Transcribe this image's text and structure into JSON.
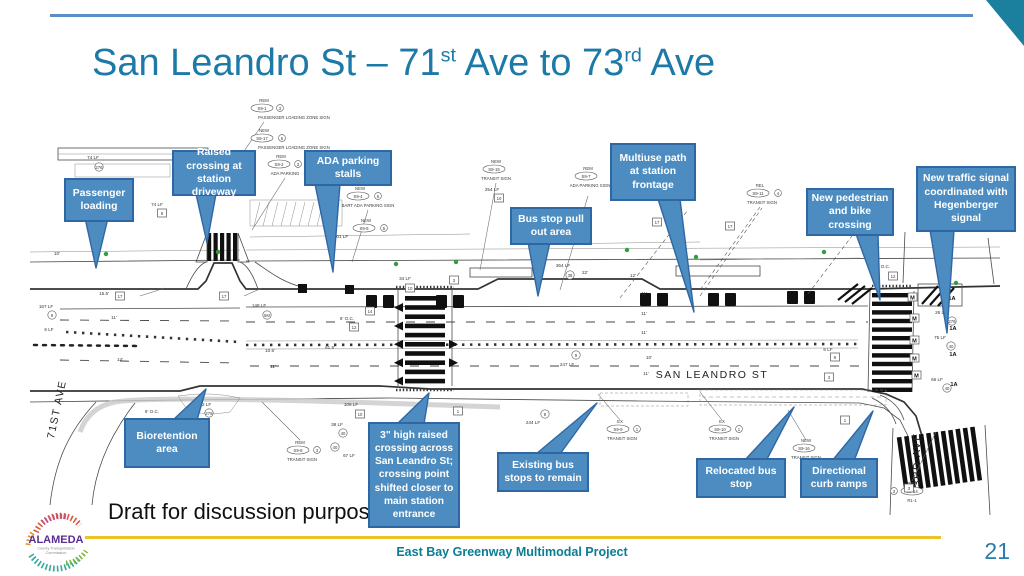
{
  "title": {
    "p1": "San Leandro St – 71",
    "s1": "st",
    "p2": " Ave to 73",
    "s2": "rd",
    "p3": " Ave"
  },
  "draft_note": "Draft for discussion purposes",
  "footer": {
    "project": "East Bay Greenway Multimodal Project",
    "page": "21"
  },
  "logo": {
    "name": "ALAMEDA",
    "sub1": "County Transportation",
    "sub2": "Commission"
  },
  "colors": {
    "accent_blue": "#4c8cc0",
    "callout_border": "#2f67a5",
    "title_teal": "#1d7aa8",
    "footer_teal": "#0a7d92",
    "gold": "#ecc228"
  },
  "callouts": [
    {
      "id": "passenger-loading",
      "text": "Passenger loading"
    },
    {
      "id": "raised-crossing-driveway",
      "text": "Raised crossing at station driveway"
    },
    {
      "id": "ada-parking-stalls",
      "text": "ADA parking stalls"
    },
    {
      "id": "bus-stop-pull-out",
      "text": "Bus stop pull out area"
    },
    {
      "id": "multiuse-path",
      "text": "Multiuse path at station frontage"
    },
    {
      "id": "new-ped-bike-crossing",
      "text": "New pedestrian and bike crossing"
    },
    {
      "id": "new-traffic-signal",
      "text": "New traffic signal coordinated with Hegenberger signal"
    },
    {
      "id": "bioretention-area",
      "text": "Bioretention area"
    },
    {
      "id": "raised-crossing-san-leandro",
      "text": "3\" high raised crossing across San Leandro St; crossing point shifted closer to main station entrance"
    },
    {
      "id": "existing-bus-stops",
      "text": "Existing bus stops to remain"
    },
    {
      "id": "relocated-bus-stop",
      "text": "Relocated bus stop"
    },
    {
      "id": "directional-curb-ramps",
      "text": "Directional curb ramps"
    }
  ],
  "plan": {
    "streets": {
      "main": "SAN LEANDRO ST",
      "left": "71ST AVE",
      "right": "73RD AVE"
    },
    "markers": {
      "m": "M",
      "a": "1A"
    },
    "tags": [
      {
        "status": "REM",
        "code": "S9-1",
        "qty": "3",
        "name": "PASSENGER LOADING ZONE SIGN"
      },
      {
        "status": "NEW",
        "code": "S9-17",
        "qty": "6",
        "name": "PASSENGER LOADING ZONE SIGN"
      },
      {
        "status": "REM",
        "code": "S9-2",
        "qty": "3",
        "name": "ADA PARKING"
      },
      {
        "status": "NEW",
        "code": "S9-4",
        "qty": "6",
        "name": "BART ADA PARKING SIGN"
      },
      {
        "status": "NEW",
        "code": "S9-5",
        "qty": "5",
        "name": ""
      },
      {
        "status": "NEW",
        "code": "S9-15",
        "qty": "",
        "name": "TRANSIT SIGN"
      },
      {
        "status": "REM",
        "code": "S9-7",
        "qty": "",
        "name": "ADA PARKING SIGN"
      },
      {
        "status": "REL",
        "code": "S9-11",
        "qty": "4",
        "name": "TRANSIT SIGN"
      },
      {
        "status": "REM",
        "code": "S9-8",
        "qty": "3",
        "name": "TRANSIT SIGN"
      },
      {
        "status": "EX",
        "code": "S9-9",
        "qty": "1",
        "name": "TRANSIT SIGN"
      },
      {
        "status": "EX",
        "code": "S9-10",
        "qty": "1",
        "name": "TRANSIT SIGN"
      },
      {
        "status": "NEW",
        "code": "S9-16",
        "qty": "",
        "name": "TRANSIT SIGN"
      },
      {
        "status": "REM",
        "code": "S9-14",
        "qty": "3",
        "name": "R1-1"
      }
    ],
    "dims": [
      {
        "t": "74 LF"
      },
      {
        "t": "74 LF"
      },
      {
        "t": "167 LF"
      },
      {
        "t": "6 LF"
      },
      {
        "t": "102 LF"
      },
      {
        "t": "101 LF"
      },
      {
        "t": "254 LF"
      },
      {
        "t": "34 LF"
      },
      {
        "t": "364 LF"
      },
      {
        "t": "148 LF"
      },
      {
        "t": "247 LF"
      },
      {
        "t": "244 LF"
      },
      {
        "t": "108 LF"
      },
      {
        "t": "38 LF"
      },
      {
        "t": "67 LF"
      },
      {
        "t": "26 LF"
      },
      {
        "t": "75 LF"
      },
      {
        "t": "66 LF"
      },
      {
        "t": "6 LF"
      }
    ],
    "widths": [
      {
        "t": "10'"
      },
      {
        "t": "15.5'"
      },
      {
        "t": "11'"
      },
      {
        "t": "14'"
      },
      {
        "t": "10.5'"
      },
      {
        "t": "11'"
      },
      {
        "t": "61.5'"
      },
      {
        "t": "22'"
      },
      {
        "t": "12'"
      },
      {
        "t": "11'"
      },
      {
        "t": "11'"
      },
      {
        "t": "11'"
      },
      {
        "t": "10'"
      },
      {
        "t": "11'"
      },
      {
        "t": "6' O.C."
      },
      {
        "t": "6' O.C."
      },
      {
        "t": "6' O.C."
      }
    ],
    "hex": [
      {
        "v": "276"
      },
      {
        "v": "9"
      },
      {
        "v": "9"
      },
      {
        "v": "276"
      },
      {
        "v": "5M"
      },
      {
        "v": "38"
      },
      {
        "v": "8"
      },
      {
        "v": "40"
      },
      {
        "v": "40"
      },
      {
        "v": "276"
      },
      {
        "v": "40"
      },
      {
        "v": "40"
      }
    ],
    "sq": [
      {
        "v": "17"
      },
      {
        "v": "17"
      },
      {
        "v": "10"
      },
      {
        "v": "3"
      },
      {
        "v": "14"
      },
      {
        "v": "12"
      },
      {
        "v": "10"
      },
      {
        "v": "1"
      },
      {
        "v": "10"
      },
      {
        "v": "9"
      },
      {
        "v": "3"
      },
      {
        "v": "12"
      },
      {
        "v": "3"
      },
      {
        "v": "8"
      },
      {
        "v": "17"
      },
      {
        "v": "17"
      },
      {
        "v": "1"
      }
    ]
  }
}
